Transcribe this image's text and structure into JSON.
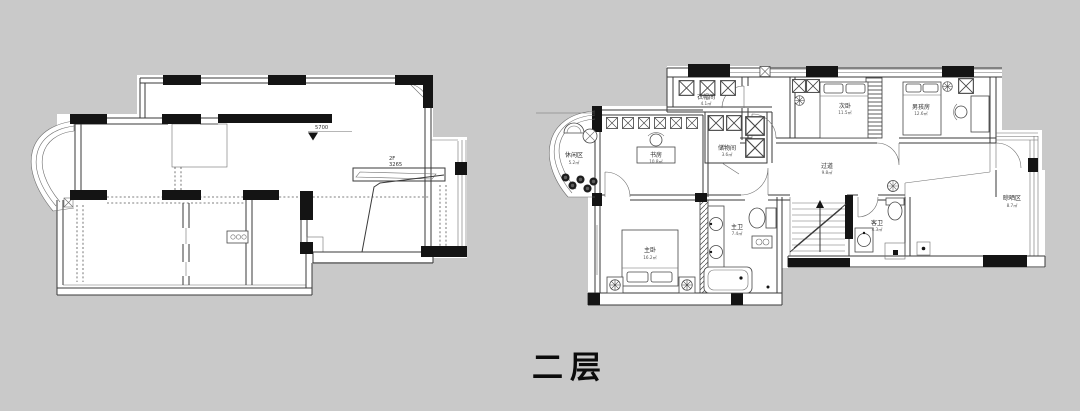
{
  "page": {
    "background": "#c9c9c9",
    "plan_fill": "#ffffff",
    "wall_color": "#3a3a3a",
    "column_color": "#141414",
    "floor_label": "二层"
  },
  "left_plan": {
    "description": "original structure plan, unfurnished",
    "elevation_marker": "5700",
    "stair_note_line1": "2F",
    "stair_note_line2": "3265"
  },
  "right_plan": {
    "description": "furnished layout plan",
    "rooms": [
      {
        "id": "leisure",
        "name": "休闲区",
        "size": "5.2㎡"
      },
      {
        "id": "cloakroom",
        "name": "衣帽间",
        "size": "4.1㎡"
      },
      {
        "id": "study",
        "name": "书房",
        "size": "10.8㎡"
      },
      {
        "id": "storage",
        "name": "储物间",
        "size": "3.6㎡"
      },
      {
        "id": "bedroom2",
        "name": "次卧",
        "size": "11.5㎡"
      },
      {
        "id": "boys-room",
        "name": "男孩房",
        "size": "12.6㎡"
      },
      {
        "id": "hallway",
        "name": "过道",
        "size": "9.8㎡"
      },
      {
        "id": "master-bed",
        "name": "主卧",
        "size": "16.2㎡"
      },
      {
        "id": "master-bath",
        "name": "主卫",
        "size": "7.4㎡"
      },
      {
        "id": "guest-bath",
        "name": "客卫",
        "size": "4.3㎡"
      },
      {
        "id": "drying-area",
        "name": "晾晒区",
        "size": "8.7㎡"
      }
    ]
  }
}
